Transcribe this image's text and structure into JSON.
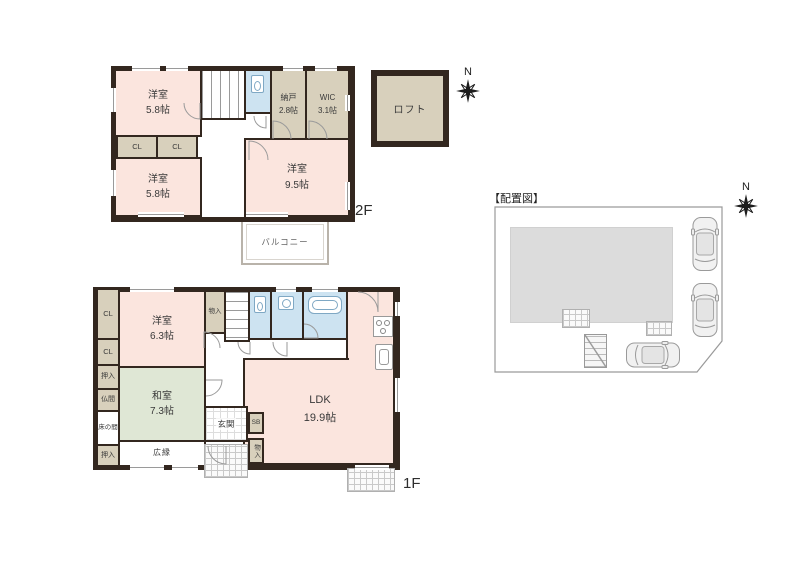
{
  "palette": {
    "wall": "#33271f",
    "room_pink": "#fbe5de",
    "closet_beige": "#d8d0bc",
    "water_blue": "#cde3f1",
    "tatami_green": "#dfe7d5",
    "site_gray": "#dcdcdc"
  },
  "compass": {
    "north": "N"
  },
  "loft": {
    "label": "ロフト"
  },
  "floor2": {
    "label": "2F",
    "rooms": {
      "yoshitsu_nw": {
        "name": "洋室",
        "size": "5.8帖"
      },
      "yoshitsu_sw": {
        "name": "洋室",
        "size": "5.8帖"
      },
      "yoshitsu_se": {
        "name": "洋室",
        "size": "9.5帖"
      },
      "nando": {
        "name": "納戸",
        "size": "2.8帖"
      },
      "wic": {
        "name": "WIC",
        "size": "3.1帖"
      },
      "cl_left": "CL",
      "cl_right": "CL",
      "balcony": "バルコニー"
    }
  },
  "floor1": {
    "label": "1F",
    "rooms": {
      "yoshitsu": {
        "name": "洋室",
        "size": "6.3帖"
      },
      "washitsu": {
        "name": "和室",
        "size": "7.3帖"
      },
      "ldk": {
        "name": "LDK",
        "size": "19.9帖"
      },
      "cl_top": "CL",
      "cl_mid": "CL",
      "oshiire_upper": "押入",
      "butsuma": "仏間",
      "tokonoma": "床の間",
      "oshiire_lower": "押入",
      "hiroen": "広縁",
      "genkan": "玄関",
      "monoire_stairs": "物入",
      "sb": "SB",
      "monoire_entry": "物入"
    }
  },
  "site": {
    "title": "【配置図】"
  }
}
